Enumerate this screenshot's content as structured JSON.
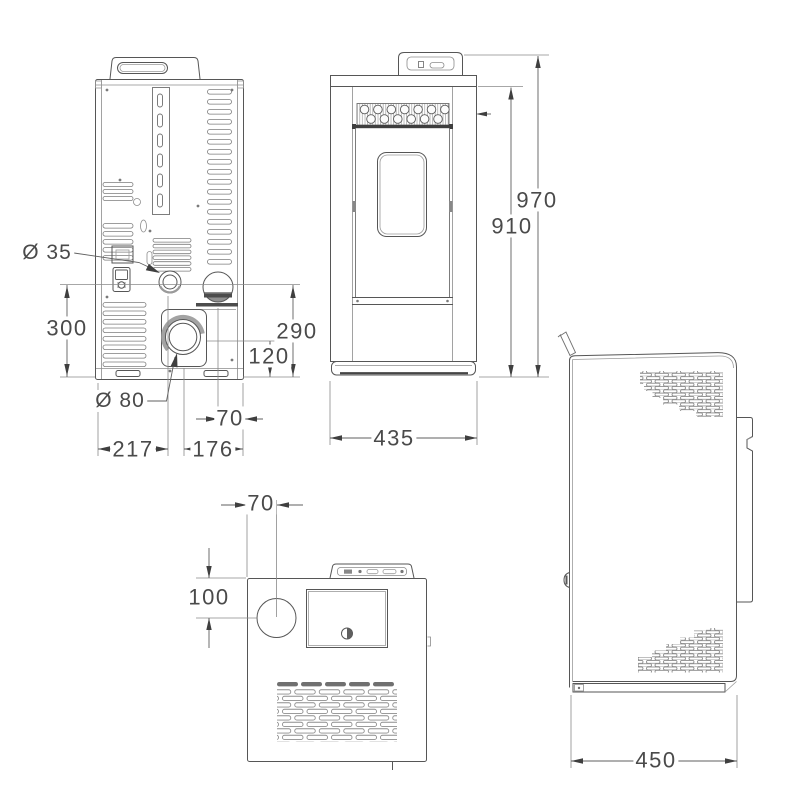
{
  "drawing": {
    "type": "technical-drawing",
    "subject": "pellet stove dimensioned orthographic views",
    "line_color": "#565656",
    "views": [
      {
        "id": "rear",
        "label": "rear view"
      },
      {
        "id": "front",
        "label": "front view"
      },
      {
        "id": "top",
        "label": "top view"
      },
      {
        "id": "side",
        "label": "side view"
      }
    ],
    "dimensions": {
      "rear": {
        "flue_diameter": "Ø 35",
        "height_300": "300",
        "outlet_diameter": "Ø 80",
        "width_217": "217",
        "width_176": "176",
        "width_70": "70",
        "height_290": "290",
        "height_120": "120"
      },
      "front": {
        "width_435": "435",
        "height_970": "970",
        "height_910": "910"
      },
      "top": {
        "offset_70": "70",
        "offset_100": "100"
      },
      "side": {
        "depth_450": "450"
      }
    }
  }
}
